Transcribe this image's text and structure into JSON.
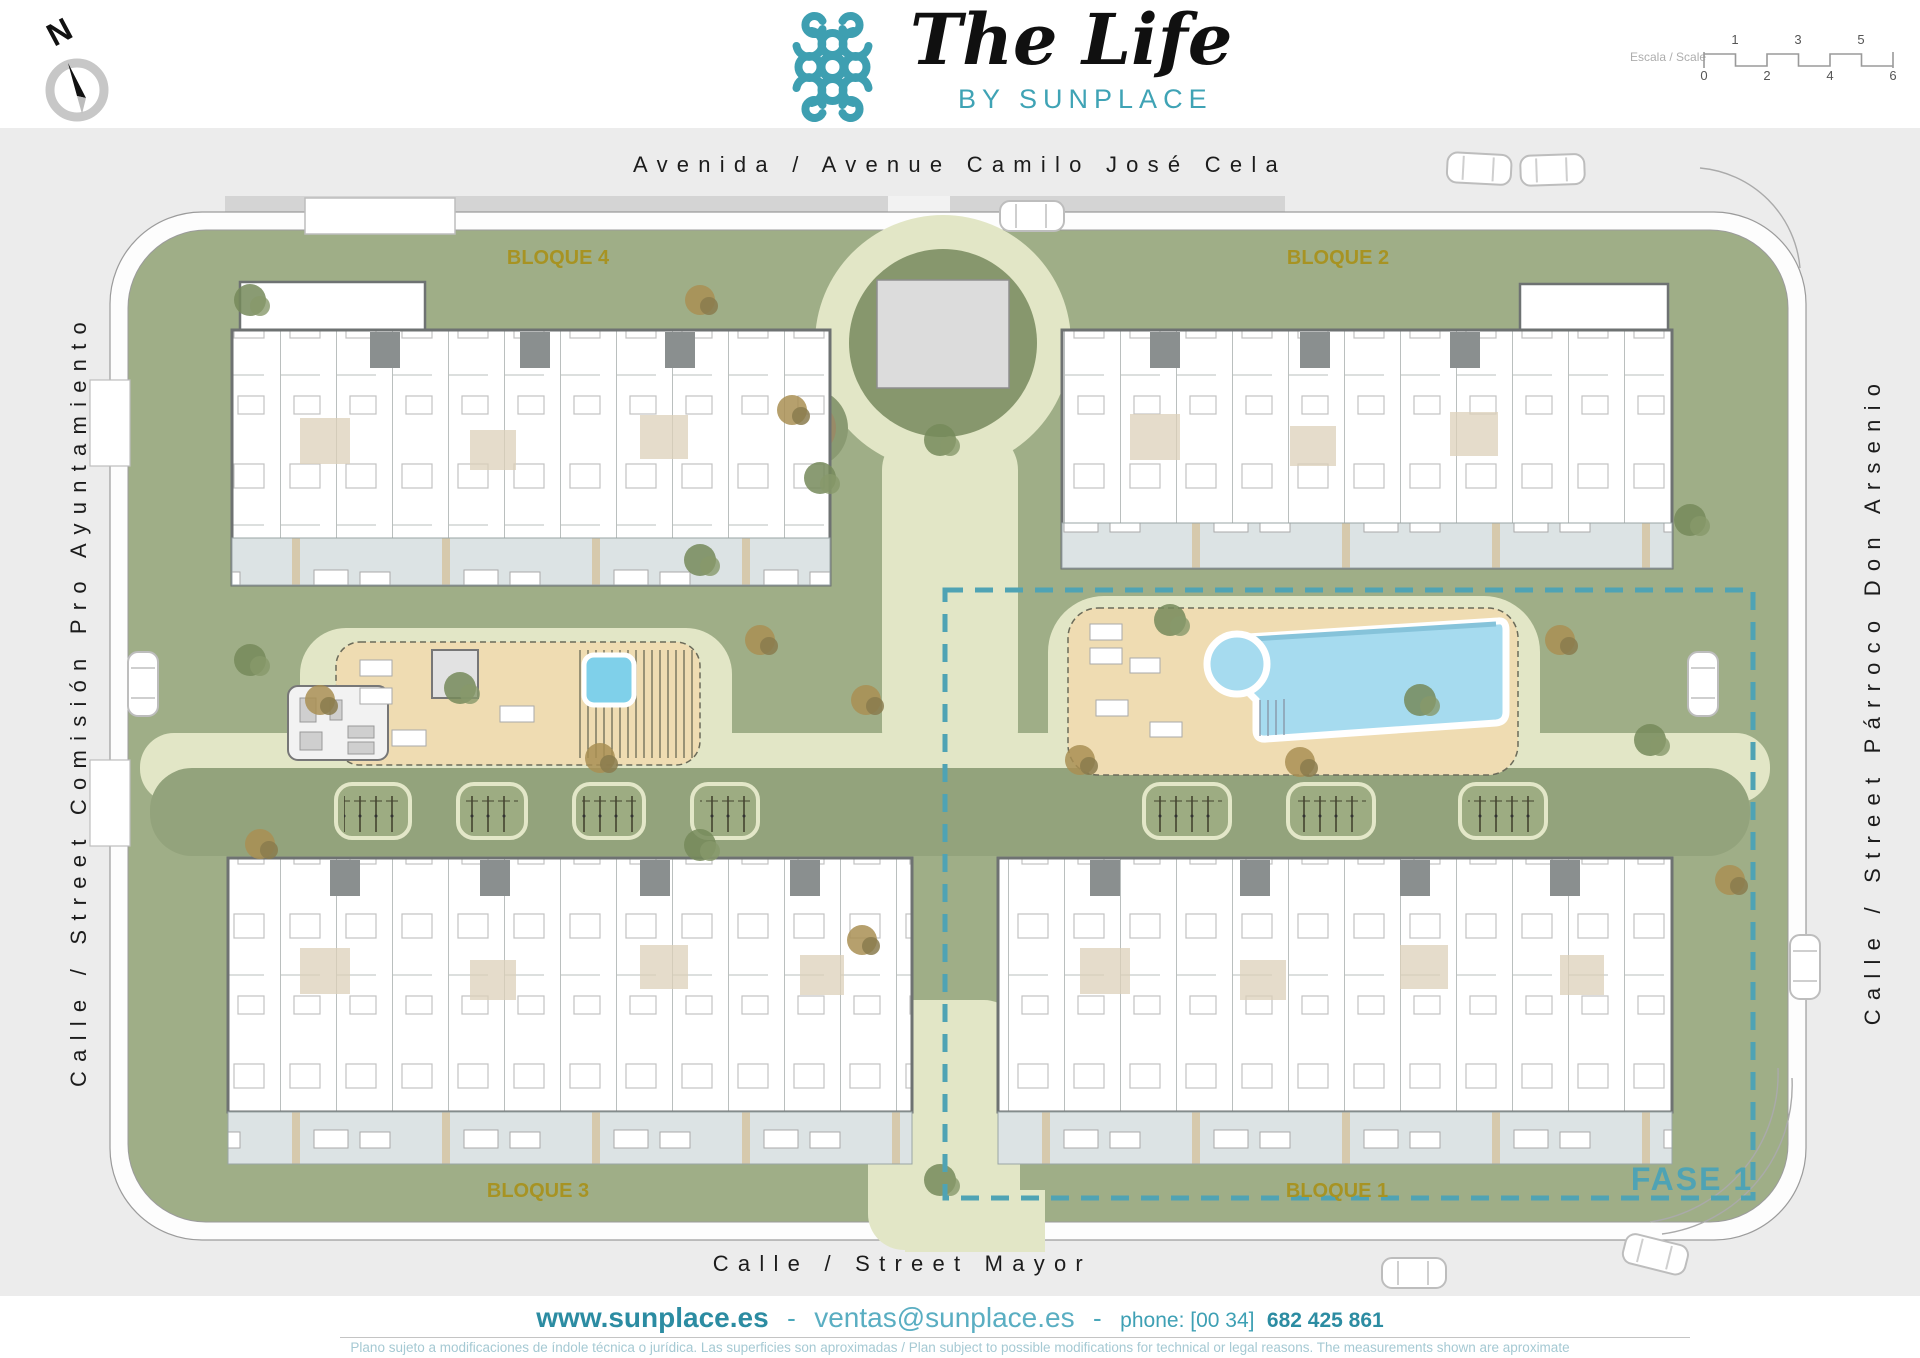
{
  "header": {
    "north_label": "N",
    "logo": {
      "title": "The Life",
      "subtitle": "BY SUNPLACE"
    },
    "scale": {
      "label": "Escala / Scale",
      "top_ticks": [
        "1",
        "3",
        "5"
      ],
      "bottom_ticks": [
        "0",
        "2",
        "4",
        "6"
      ]
    }
  },
  "streets": {
    "top": "Avenida / Avenue Camilo José Cela",
    "bottom": "Calle / Street Mayor",
    "left": "Calle / Street Comisión Pro Ayuntamiento",
    "right": "Calle / Street Párroco Don Arsenio"
  },
  "blocks": {
    "bloque1": "BLOQUE 1",
    "bloque2": "BLOQUE 2",
    "bloque3": "BLOQUE 3",
    "bloque4": "BLOQUE 4"
  },
  "phase": {
    "label": "FASE 1"
  },
  "footer": {
    "website": "www.sunplace.es",
    "separator": "-",
    "email": "ventas@sunplace.es",
    "phone_label": "phone: [00 34]",
    "phone_number": "682 425 861",
    "disclaimer": "Plano sujeto a modificaciones de índole técnica o jurídica. Las superficies son aproximadas / Plan subject to possible modifications for technical or legal reasons. The measurements  shown are aproximate"
  },
  "colors": {
    "teal": "#3E9FB1",
    "olive_label": "#A79323",
    "pool_blue": "#A6DBEF",
    "deck_tan": "#EFDCB2",
    "green": "#9FAE87",
    "path_pale": "#E2E6C6",
    "street_gray": "#ECECEC"
  }
}
